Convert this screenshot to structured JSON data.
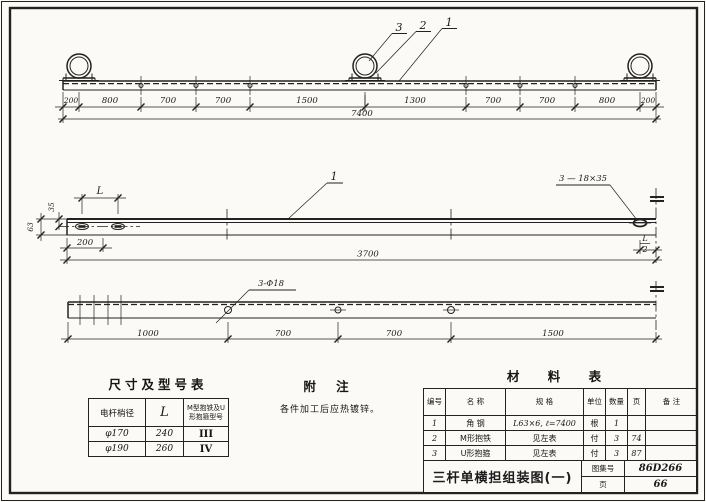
{
  "top_view": {
    "callouts": [
      "3",
      "2",
      "1"
    ],
    "dims": [
      "200",
      "800",
      "700",
      "700",
      "1500",
      "1300",
      "700",
      "700",
      "800",
      "200"
    ],
    "overall": "7400"
  },
  "middle_view": {
    "part_callout": "1",
    "hole_callout": "3 — 18×35",
    "dim_l": "L",
    "dim_width": "63",
    "dim_offset": "35",
    "dim_end": "200",
    "dim_total": "3700",
    "frac_num": "L",
    "frac_den": "2"
  },
  "bottom_view": {
    "hole_callout": "3-Φ18",
    "dims": [
      "1000",
      "700",
      "700",
      "1500"
    ]
  },
  "size_table": {
    "title": "尺寸及型号表",
    "headers": [
      "电杆梢径",
      "L",
      "M型抱铁及U形抱箍型号"
    ],
    "rows": [
      [
        "φ170",
        "240",
        "III"
      ],
      [
        "φ190",
        "260",
        "IV"
      ]
    ]
  },
  "notes": {
    "title": "附  注",
    "body": "各件加工后应热镀锌。"
  },
  "material_table": {
    "title": "材  料  表",
    "headers": [
      "编号",
      "名  称",
      "规  格",
      "单位",
      "数量",
      "页",
      "备  注"
    ],
    "rows": [
      [
        "1",
        "角  钢",
        "L63×6, ℓ=7400",
        "根",
        "1",
        ""
      ],
      [
        "2",
        "M形抱铁",
        "见左表",
        "付",
        "3",
        "74"
      ],
      [
        "3",
        "U形抱箍",
        "见左表",
        "付",
        "3",
        "87"
      ]
    ]
  },
  "title_block": {
    "title": "三杆单横担组装图(一)",
    "atlas_label": "图集号",
    "atlas_no": "86D266",
    "page_label": "页",
    "page_no": "66"
  }
}
